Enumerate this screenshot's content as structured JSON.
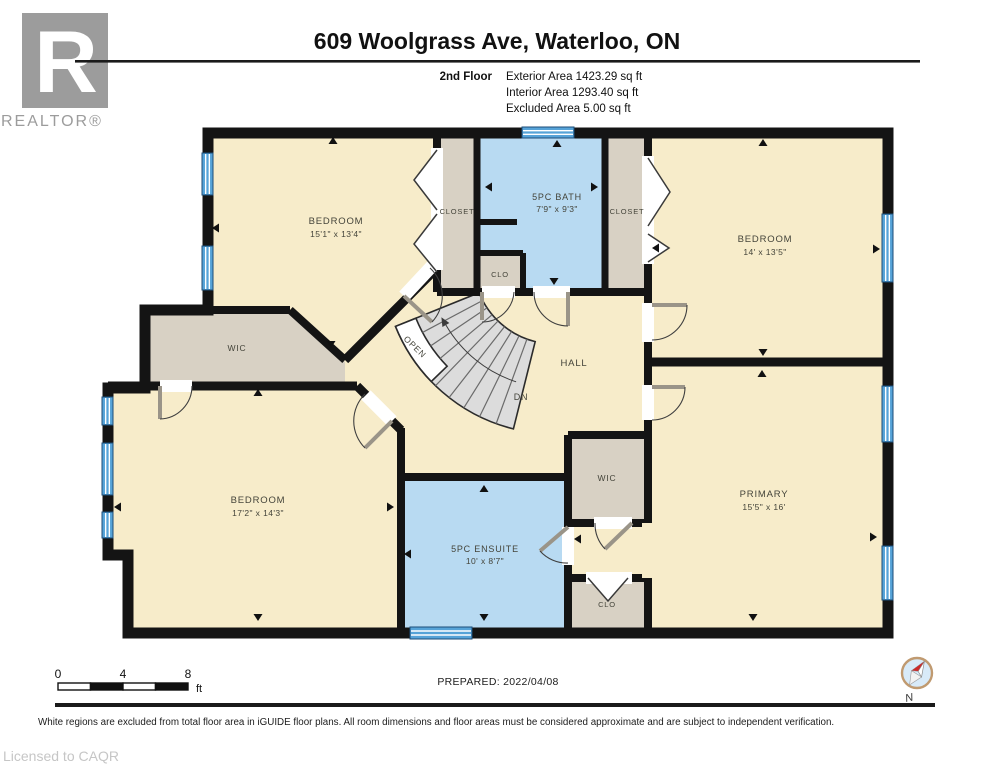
{
  "header": {
    "title": "609 Woolgrass Ave, Waterloo, ON",
    "floor_label": "2nd Floor",
    "area_lines": [
      "Exterior Area 1423.29 sq ft",
      "Interior Area 1293.40 sq ft",
      "Excluded Area 5.00 sq ft"
    ]
  },
  "logo": {
    "letter": "R",
    "brand": "REALTOR®"
  },
  "rooms": {
    "bedroom_tl": {
      "name": "BEDROOM",
      "dims": "15'1\" x 13'4\""
    },
    "closet_l": {
      "name": "CLOSET"
    },
    "bath": {
      "name": "5PC BATH",
      "dims": "7'9\" x 9'3\""
    },
    "closet_r": {
      "name": "CLOSET"
    },
    "bedroom_tr": {
      "name": "BEDROOM",
      "dims": "14' x 13'5\""
    },
    "clo_bath": {
      "name": "CLO"
    },
    "wic_left": {
      "name": "WIC"
    },
    "hall": {
      "name": "HALL"
    },
    "bedroom_bl": {
      "name": "BEDROOM",
      "dims": "17'2\" x 14'3\""
    },
    "ensuite": {
      "name": "5PC ENSUITE",
      "dims": "10' x 8'7\""
    },
    "wic_right": {
      "name": "WIC"
    },
    "clo_bottom": {
      "name": "CLO"
    },
    "primary": {
      "name": "PRIMARY",
      "dims": "15'5\" x 16'"
    }
  },
  "stairs": {
    "open_label": "OPEN",
    "down_label": "DN"
  },
  "scale_bar": {
    "ticks": [
      "0",
      "4",
      "8"
    ],
    "unit": "ft"
  },
  "footer": {
    "prepared": "PREPARED: 2022/04/08",
    "disclaimer": "White regions are excluded from total floor area in iGUIDE floor plans. All room dimensions and floor areas must be considered approximate and are subject to independent verification.",
    "license": "Licensed to CAQR",
    "compass_label": "N"
  }
}
